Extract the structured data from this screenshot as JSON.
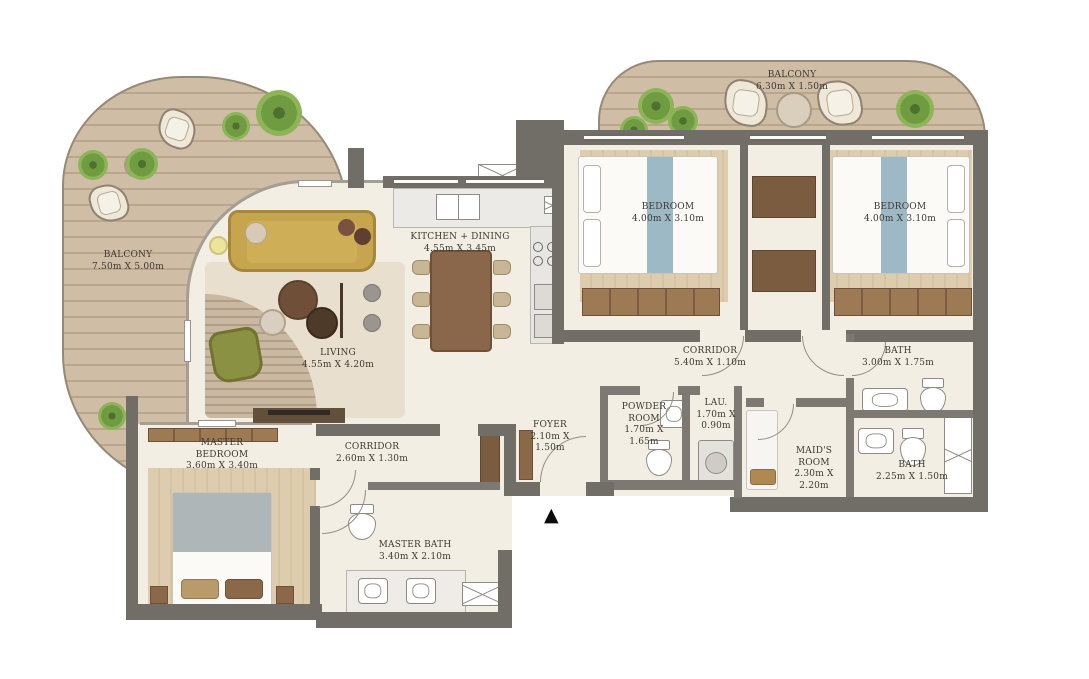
{
  "colors": {
    "wall": "#716d67",
    "floor": "#f3eee3",
    "deck": "#cfbda5",
    "sofa": "#c6a54e",
    "armchair": "#8b9143",
    "bed_runner": "#9db9c5",
    "wood": "#8a6848",
    "plant": "#6f9b41",
    "label_text": "#3e3933"
  },
  "rooms": [
    {
      "id": "balcony-left",
      "name": "BALCONY",
      "dims": "7.50m X 5.00m"
    },
    {
      "id": "balcony-top",
      "name": "BALCONY",
      "dims": "6.30m X 1.50m"
    },
    {
      "id": "bedroom-1",
      "name": "BEDROOM",
      "dims": "4.00m X 3.10m"
    },
    {
      "id": "bedroom-2",
      "name": "BEDROOM",
      "dims": "4.00m X 3.10m"
    },
    {
      "id": "kitchen-dining",
      "name": "KITCHEN + DINING",
      "dims": "4.55m X 3.45m"
    },
    {
      "id": "living",
      "name": "LIVING",
      "dims": "4.55m X 4.20m"
    },
    {
      "id": "corridor-main",
      "name": "CORRIDOR",
      "dims": "5.40m X 1.10m"
    },
    {
      "id": "bath-1",
      "name": "BATH",
      "dims": "3.00m X 1.75m"
    },
    {
      "id": "master-bedroom",
      "name": "MASTER BEDROOM",
      "dims": "3.60m X 3.40m"
    },
    {
      "id": "corridor-2",
      "name": "CORRIDOR",
      "dims": "2.60m X 1.30m"
    },
    {
      "id": "foyer",
      "name": "FOYER",
      "dims": "2.10m X 1.50m"
    },
    {
      "id": "powder-room",
      "name": "POWDER ROOM",
      "dims": "1.70m X 1.65m"
    },
    {
      "id": "laundry",
      "name": "LAU.",
      "dims": "1.70m X 0.90m"
    },
    {
      "id": "maids-room",
      "name": "MAID'S ROOM",
      "dims": "2.30m X 2.20m"
    },
    {
      "id": "bath-2",
      "name": "BATH",
      "dims": "2.25m X 1.50m"
    },
    {
      "id": "master-bath",
      "name": "MASTER BATH",
      "dims": "3.40m X 2.10m"
    }
  ],
  "markers": {
    "entrance_arrow": "▲"
  }
}
